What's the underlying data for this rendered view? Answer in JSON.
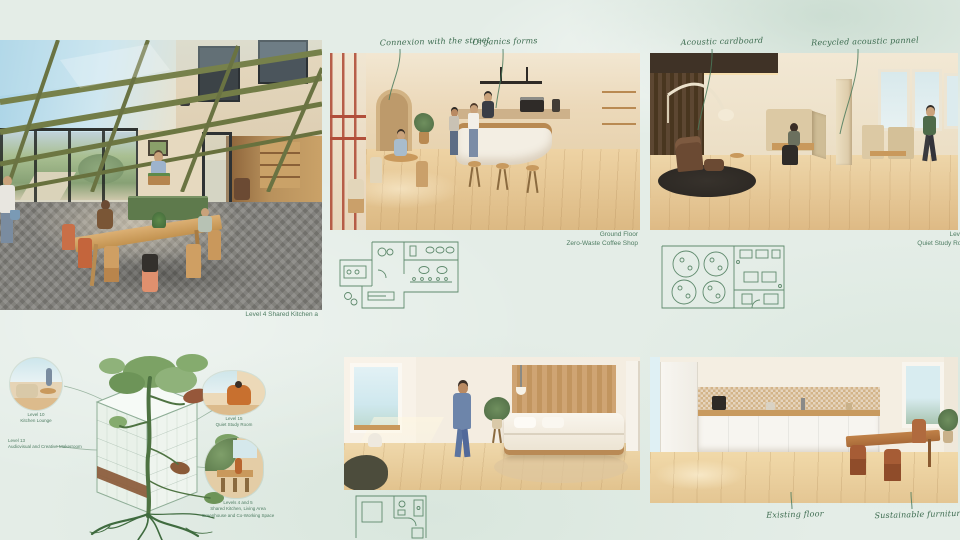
{
  "board": {
    "background": "#e4ede7",
    "accent_green": "#3c6b4f",
    "plan_green": "#5f8a6d"
  },
  "terrace": {
    "caption": "Level 4 Shared Kitchen a"
  },
  "coffee_shop": {
    "annotations": {
      "street": "Connexion with the street",
      "forms": "Organics forms"
    },
    "caption": {
      "line1": "Ground Floor",
      "line2": "Zero-Waste Coffee Shop"
    }
  },
  "study_room": {
    "annotations": {
      "cardboard": "Acoustic cardboard",
      "panel": "Recycled acoustic pannel"
    },
    "caption": {
      "line1": "Level",
      "line2": "Quiet Study Roo"
    }
  },
  "stack_diagram": {
    "callouts": {
      "kitchen_lounge": {
        "line1": "Level 10",
        "line2": "Kitchen Lounge"
      },
      "quiet_study": {
        "line1": "Level 15",
        "line2": "Quiet Study Room"
      },
      "makerspace": {
        "line1": "Level 13",
        "line2": "Audiovisual and Creative Makerroom"
      },
      "shared_levels": {
        "line1": "Levels 4 and 5",
        "line2": "Shared Kitchen, Living Area",
        "line3": "Greenhouse and Co-Working Space"
      }
    }
  },
  "kitchen": {
    "annotations": {
      "floor": "Existing floor",
      "furniture": "Sustainable furniture"
    }
  }
}
